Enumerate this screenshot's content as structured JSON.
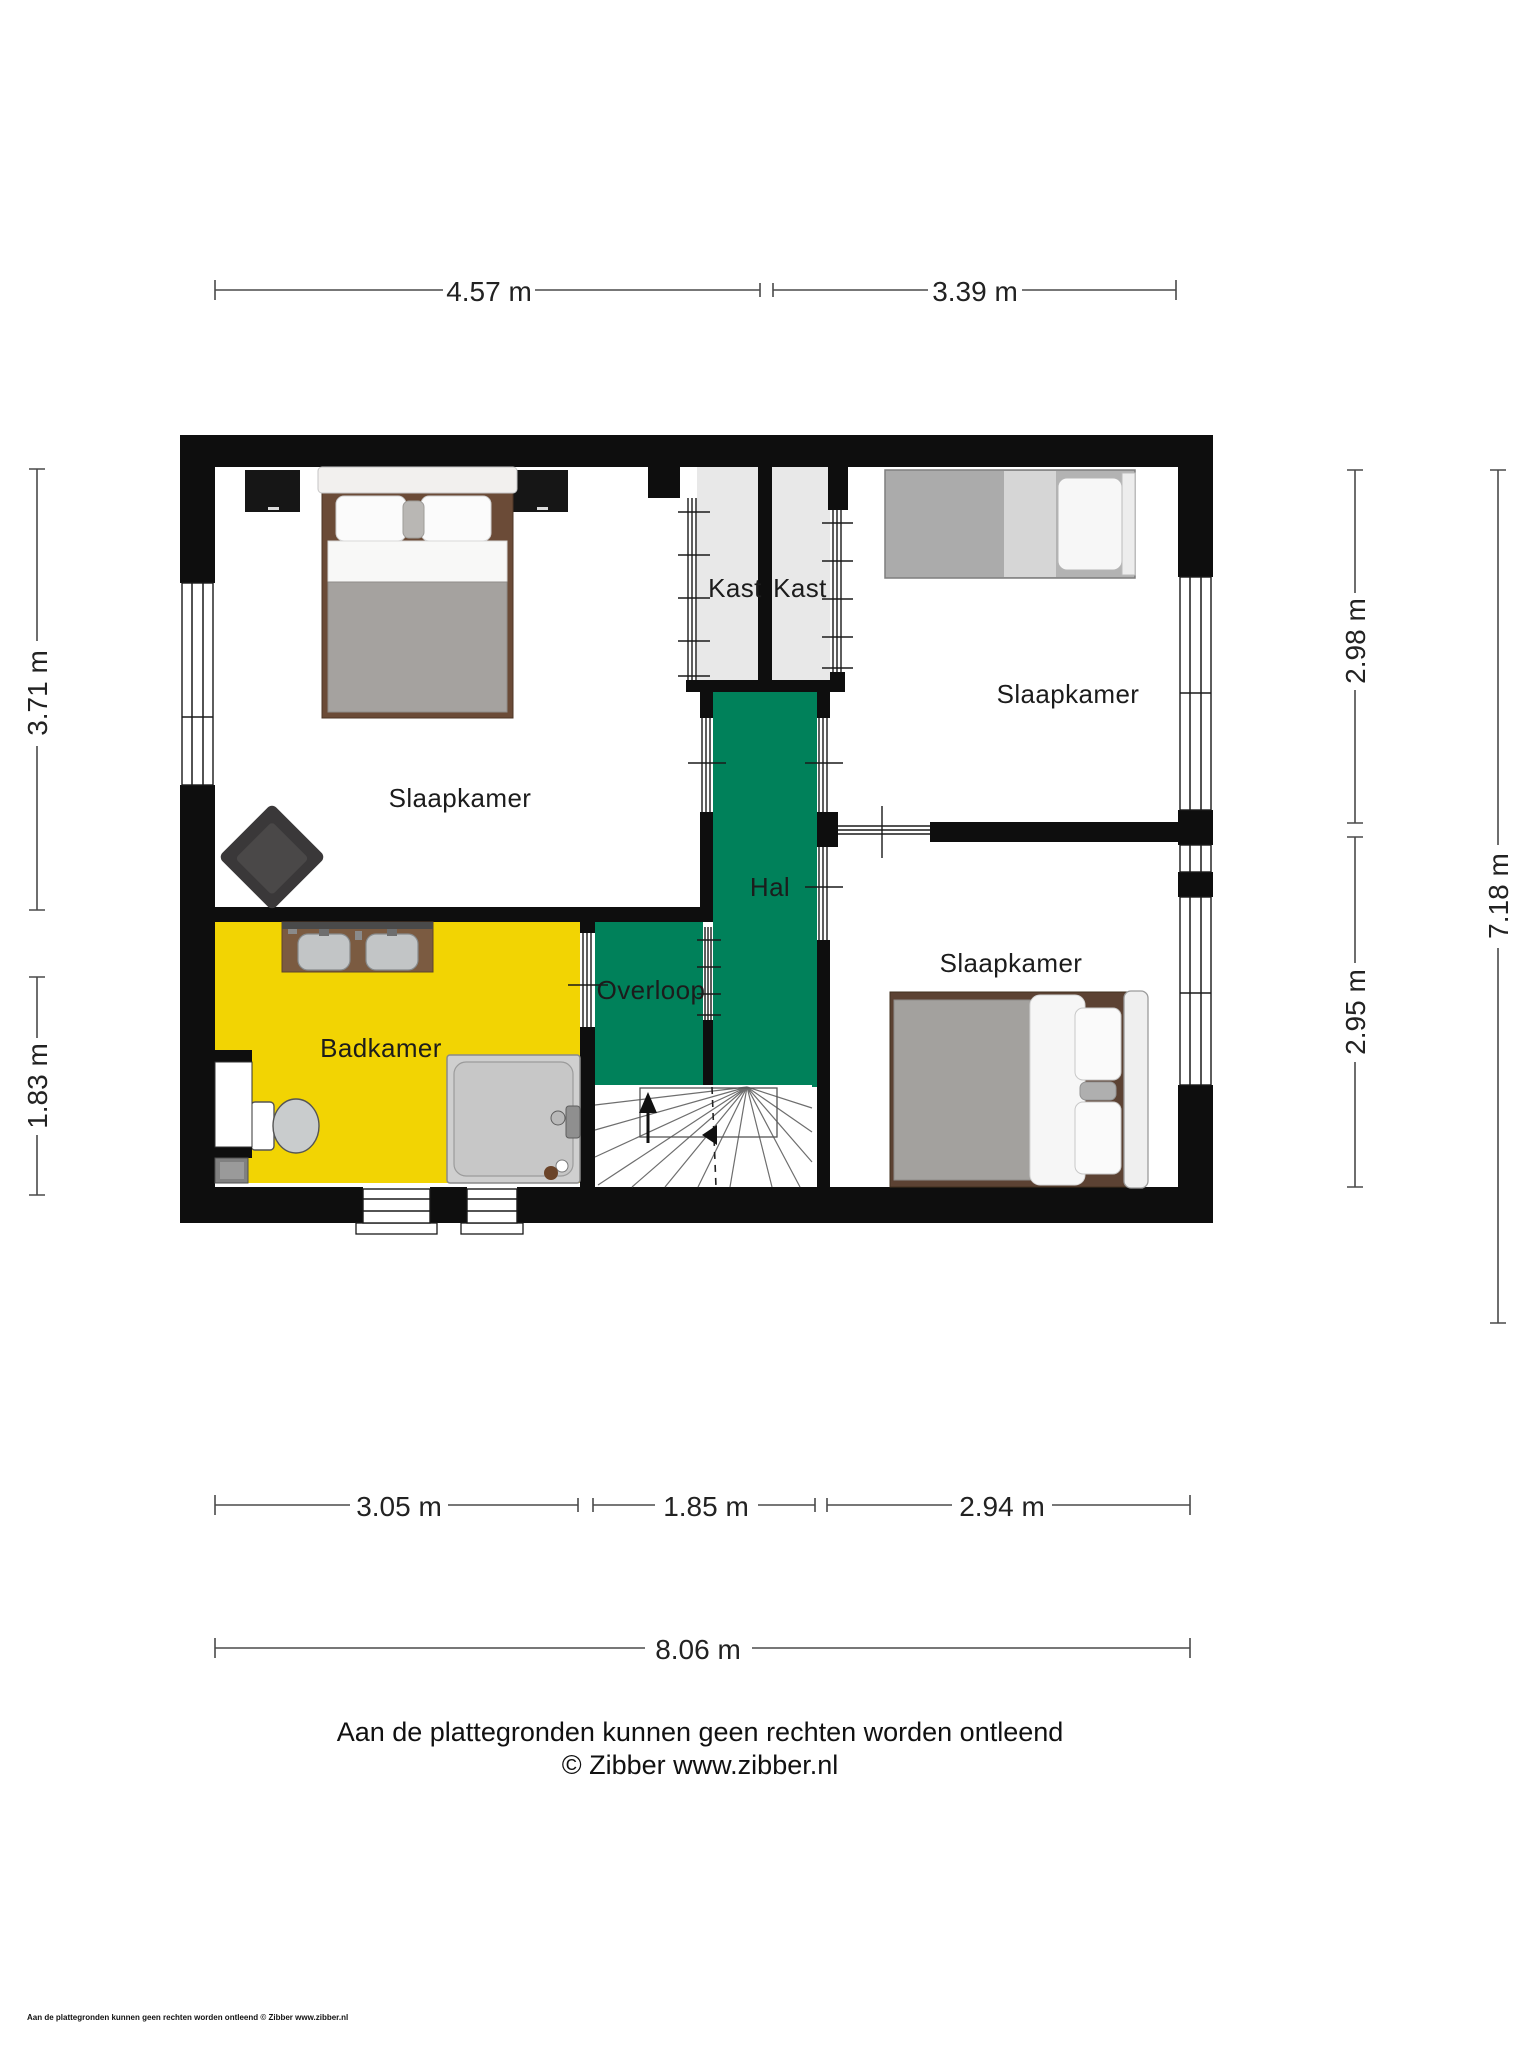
{
  "plan": {
    "room_labels": {
      "bedroom_left": "Slaapkamer",
      "bedroom_top_right": "Slaapkamer",
      "bedroom_bottom_right": "Slaapkamer",
      "closet_left": "Kast",
      "closet_right": "Kast",
      "hall": "Hal",
      "landing": "Overloop",
      "bathroom": "Badkamer"
    },
    "dimensions": {
      "top": [
        "4.57 m",
        "3.39 m"
      ],
      "bottom": [
        "3.05 m",
        "1.85 m",
        "2.94 m"
      ],
      "bottom_total": "8.06 m",
      "left": [
        "3.71 m",
        "1.83 m"
      ],
      "right": [
        "2.98 m",
        "2.95 m"
      ],
      "right_total": "7.18 m"
    },
    "colors": {
      "wall": "#0e0e0e",
      "hall_green": "#00815a",
      "bathroom_yellow": "#f2d403",
      "closet_gray": "#e8e8e8",
      "room_white": "#ffffff"
    }
  },
  "footer": {
    "disclaimer": "Aan de plattegronden kunnen geen rechten worden ontleend",
    "credit": "© Zibber www.zibber.nl",
    "watermark": "Aan de plattegronden kunnen geen rechten worden ontleend © Zibber www.zibber.nl"
  }
}
